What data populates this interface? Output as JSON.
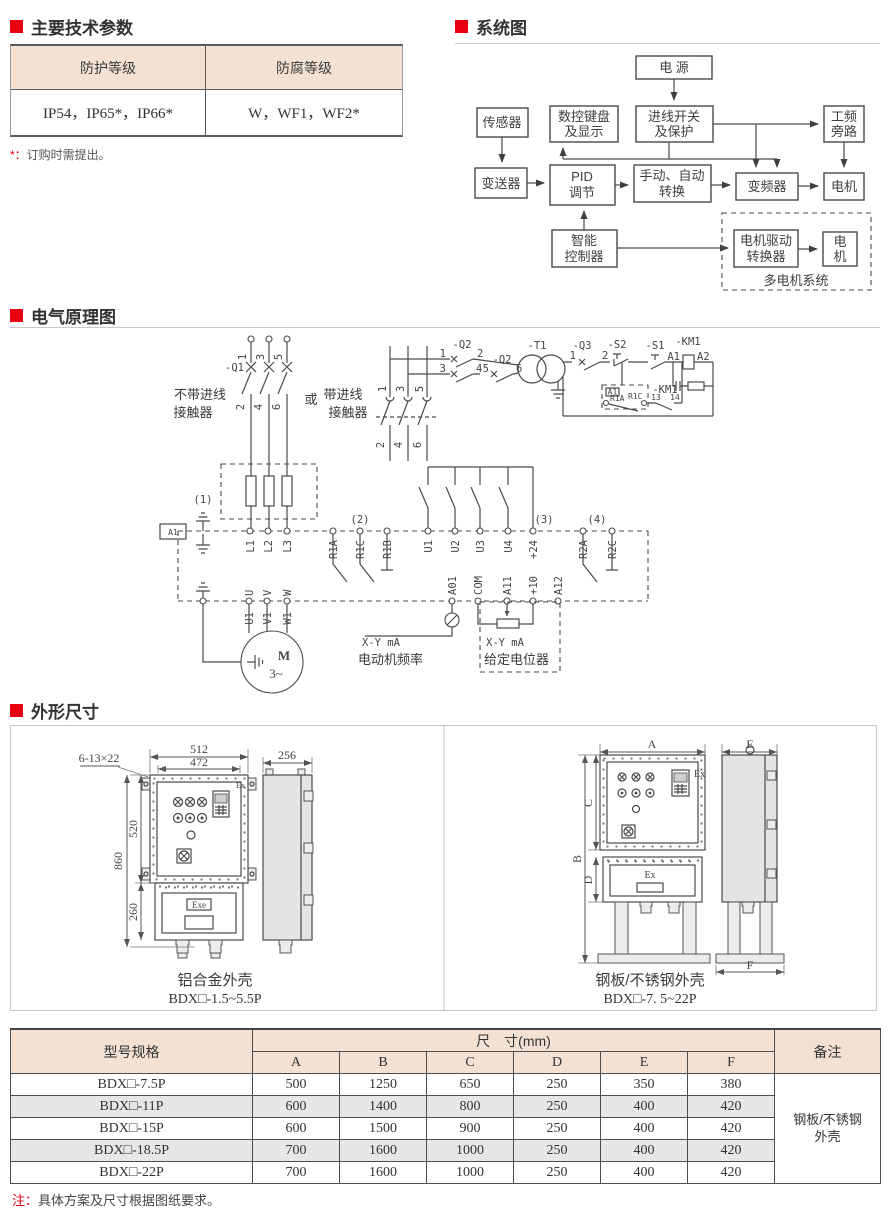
{
  "colors": {
    "accent": "#e60012",
    "peach": "#f3e2d4",
    "gray_row": "#e7e7e7"
  },
  "tech_params": {
    "title": "主要技术参数",
    "headers": [
      "防护等级",
      "防腐等级"
    ],
    "values": [
      "IP54，IP65*，IP66*",
      "W，WF1，WF2*"
    ],
    "note_star": "*：",
    "note_text": "订购时需提出。"
  },
  "system_diagram": {
    "title": "系统图",
    "labels": {
      "power": "电 源",
      "sensor": "传感器",
      "keypad1": "数控键盘",
      "keypad2": "及显示",
      "inlet1": "进线开关",
      "inlet2": "及保护",
      "bypass1": "工频",
      "bypass2": "旁路",
      "transmitter": "变送器",
      "pid1": "PID",
      "pid2": "调节",
      "manual1": "手动、自动",
      "manual2": "转换",
      "vfd": "变频器",
      "motor": "电机",
      "smart1": "智能",
      "smart2": "控制器",
      "drive1": "电机驱动",
      "drive2": "转换器",
      "motor2_1": "电",
      "motor2_2": "机",
      "multi": "多电机系统"
    }
  },
  "schematic": {
    "title": "电气原理图",
    "labels": {
      "q1": "-Q1",
      "q2": "-Q2",
      "t1": "-T1",
      "q3": "-Q3",
      "s2": "-S2",
      "s1": "-S1",
      "km1": "-KM1",
      "a1": "A1",
      "a2": "A2",
      "n13": "13",
      "n14": "14",
      "r1a": "R1A",
      "r1b": "R1B",
      "r1c": "R1C",
      "r2a": "R2A",
      "r2c": "R2C",
      "l1": "L1",
      "l2": "L2",
      "l3": "L3",
      "u1": "U1",
      "u2": "U2",
      "u3": "U3",
      "u4": "U4",
      "p24": "+24",
      "u": "U",
      "v": "V",
      "w": "W",
      "v1": "V1",
      "w1": "W1",
      "a01": "A01",
      "com": "COM",
      "a11": "A11",
      "p10": "+10",
      "a12": "A12",
      "m": "M",
      "m3": "3~",
      "p1": "(1)",
      "p2": "(2)",
      "p3": "(3)",
      "p4": "(4)",
      "xy": "X-Y mA",
      "freq": "电动机频率",
      "pot": "给定电位器",
      "no_contactor1": "不带进线",
      "contactor_word": "接触器",
      "or": "或",
      "with_contactor1": "带进线",
      "d1": "1",
      "d2": "2",
      "d3": "3",
      "d4": "4",
      "d5": "5",
      "d6": "6"
    }
  },
  "outline": {
    "title": "外形尺寸",
    "left": {
      "w1": "512",
      "w2": "472",
      "holes": "6-13×22",
      "h1": "860",
      "h2": "520",
      "h3": "260",
      "depth": "256",
      "ex": "Ex",
      "exe": "Exe",
      "caption": "铝合金外壳",
      "model": "BDX□-1.5~5.5P"
    },
    "right": {
      "a": "A",
      "b": "B",
      "c": "C",
      "d": "D",
      "e": "E",
      "f": "F",
      "ex": "Ex",
      "ex2": "Ex",
      "caption": "钢板/不锈钢外壳",
      "model": "BDX□-7. 5~22P"
    }
  },
  "size_table": {
    "header_model": "型号规格",
    "header_dim": "尺　寸(mm)",
    "cols": [
      "A",
      "B",
      "C",
      "D",
      "E",
      "F"
    ],
    "header_remark": "备注",
    "rows": [
      [
        "BDX□-7.5P",
        "500",
        "1250",
        "650",
        "250",
        "350",
        "380"
      ],
      [
        "BDX□-11P",
        "600",
        "1400",
        "800",
        "250",
        "400",
        "420"
      ],
      [
        "BDX□-15P",
        "600",
        "1500",
        "900",
        "250",
        "400",
        "420"
      ],
      [
        "BDX□-18.5P",
        "700",
        "1600",
        "1000",
        "250",
        "400",
        "420"
      ],
      [
        "BDX□-22P",
        "700",
        "1600",
        "1000",
        "250",
        "400",
        "420"
      ]
    ],
    "remark1": "钢板/不锈钢",
    "remark2": "外壳",
    "note_label": "注：",
    "note": "具体方案及尺寸根据图纸要求。"
  }
}
